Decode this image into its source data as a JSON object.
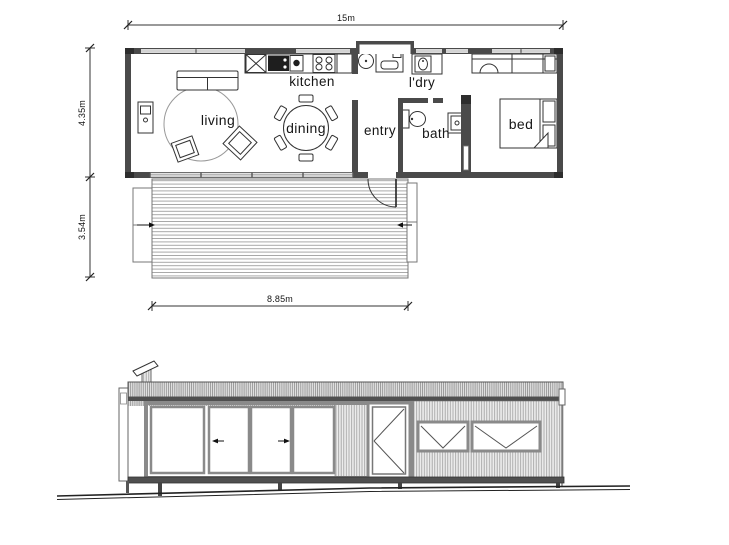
{
  "drawing": {
    "title": "floor-plan-and-elevation"
  },
  "plan": {
    "dimensions": {
      "width": "15m",
      "house_depth": "4.35m",
      "deck_depth": "3.54m",
      "deck_width": "8.85m"
    },
    "rooms": {
      "living": "living",
      "kitchen": "kitchen",
      "dining": "dining",
      "entry": "entry",
      "laundry": "l'dry",
      "bath": "bath",
      "bed": "bed"
    }
  },
  "colors": {
    "wall": "#4a4a4a",
    "wall_dark": "#2d2d2d",
    "line": "#333333",
    "light_line": "#999999",
    "cladding_line": "#9f9f9f",
    "glazing_frame": "#8a8a8a",
    "background": "#ffffff"
  }
}
